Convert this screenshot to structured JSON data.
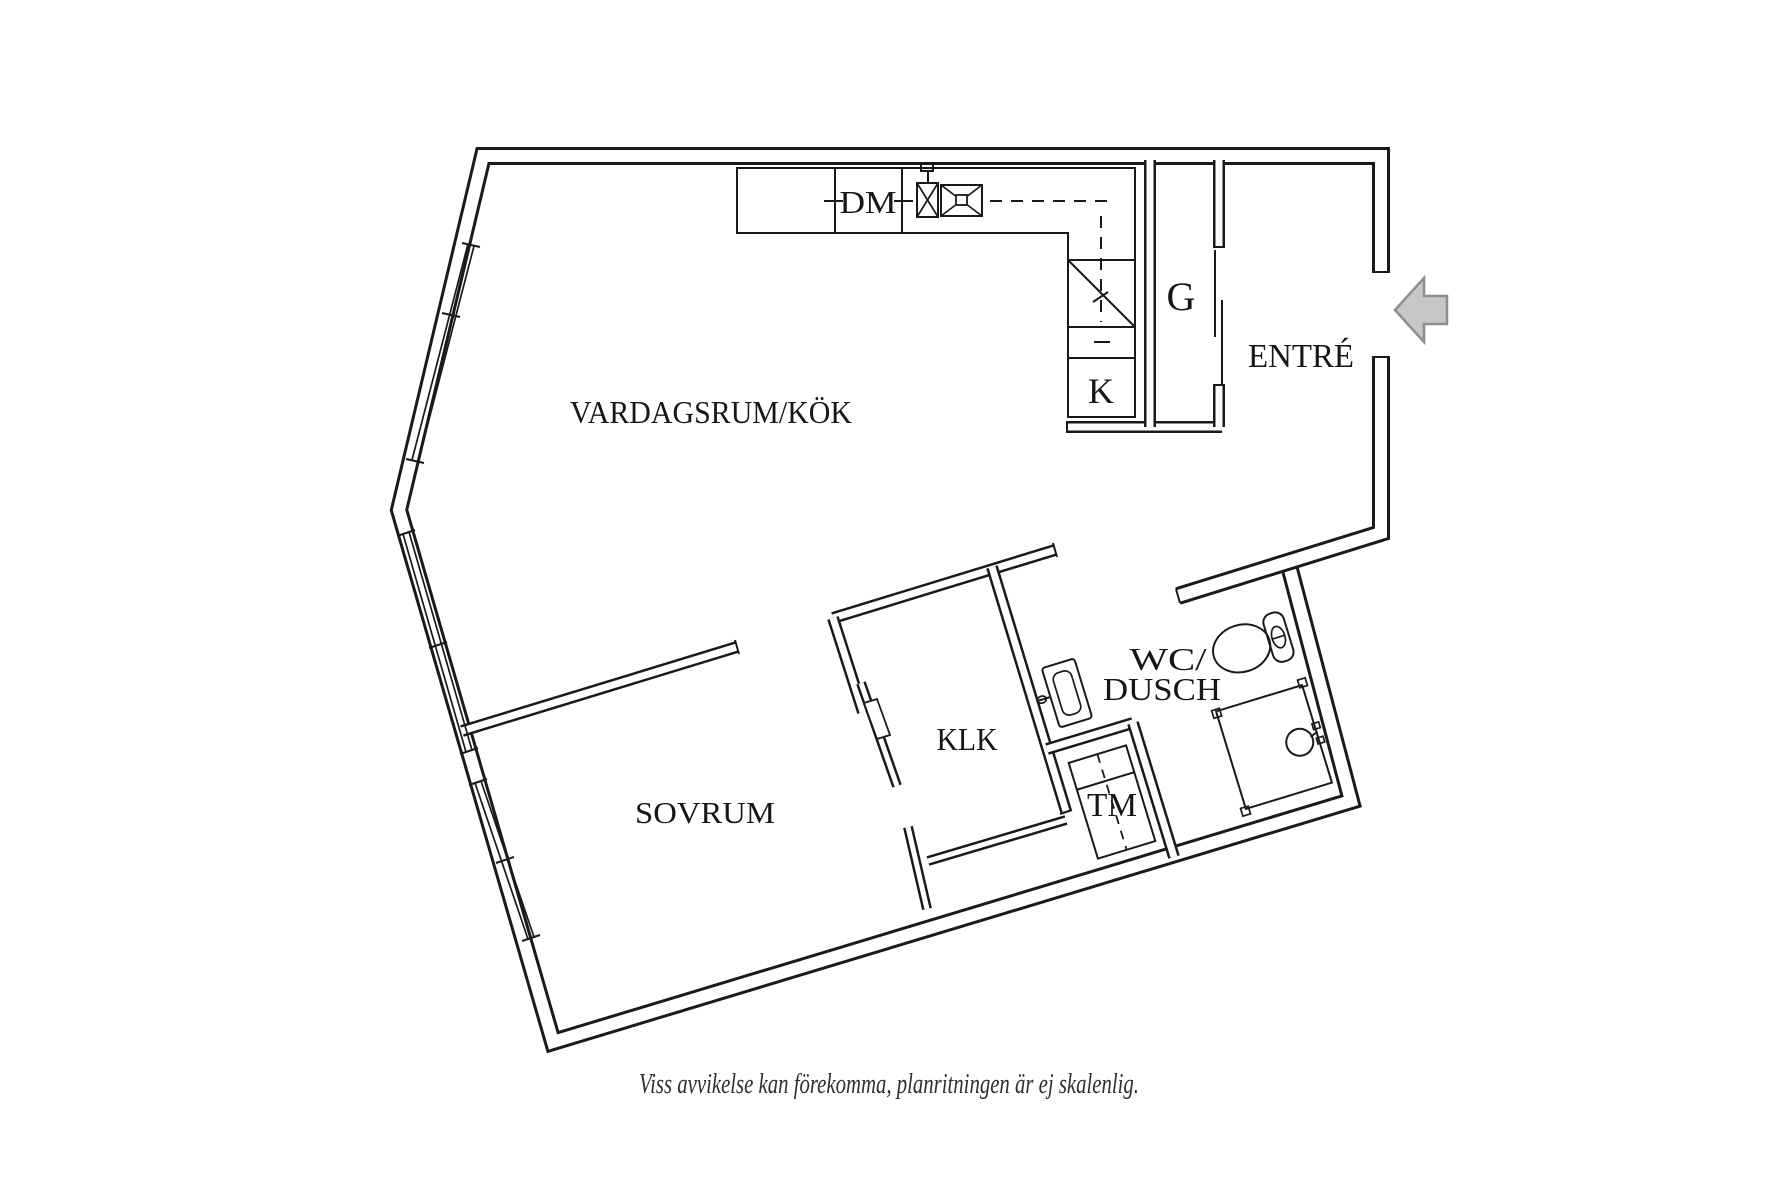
{
  "floor_plan": {
    "rooms": {
      "living_kitchen": "VARDAGSRUM/KÖK",
      "bedroom": "SOVRUM",
      "entrance": "ENTRÉ",
      "walk_in_closet": "KLK",
      "wc_shower_line1": "WC/",
      "wc_shower_line2": "DUSCH"
    },
    "markings": {
      "dishwasher": "DM",
      "fridge": "K",
      "wardrobe": "G",
      "washing_machine": "TM"
    },
    "caption": "Viss avvikelse kan förekomma, planritningen är ej skalenlig.",
    "colors": {
      "background": "#ffffff",
      "lines": "#1a1a1a",
      "arrow_fill": "#c7c7c7",
      "arrow_stroke": "#8e8e8e",
      "caption_text": "#2f2f2f"
    }
  }
}
